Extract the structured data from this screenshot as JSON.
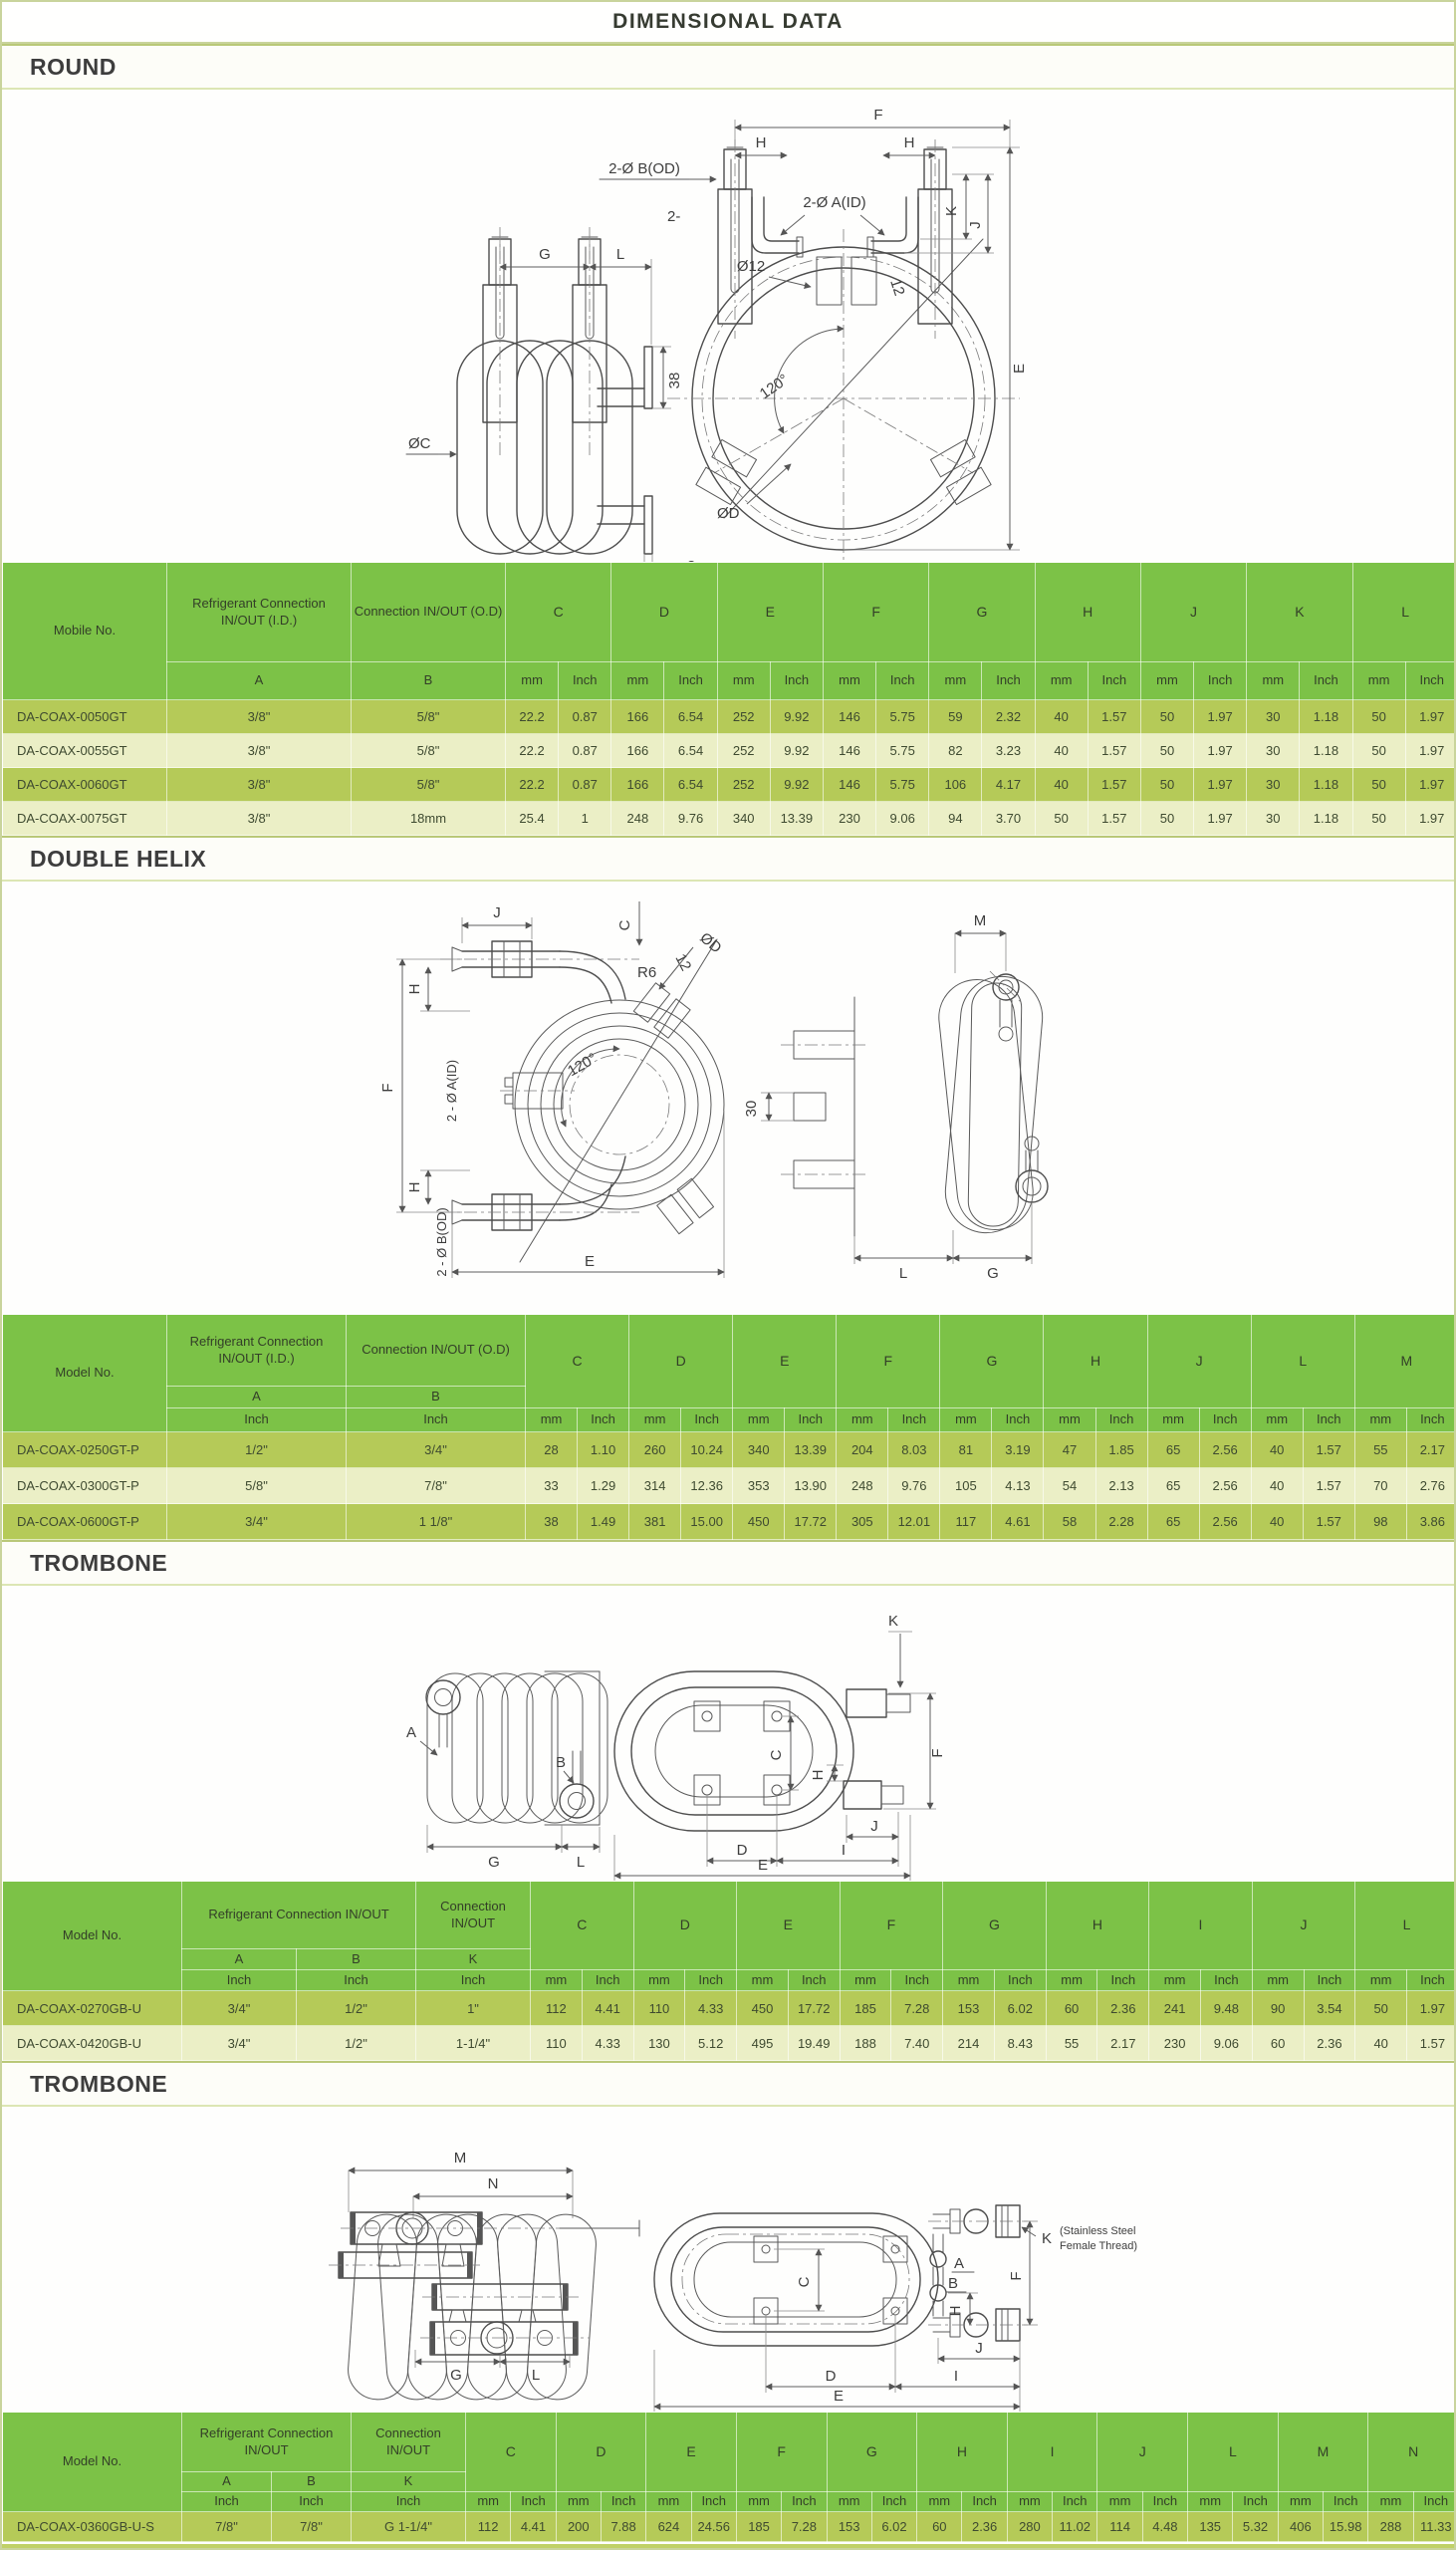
{
  "page": {
    "title": "DIMENSIONAL DATA"
  },
  "sections": [
    {
      "heading": "ROUND"
    },
    {
      "heading": "DOUBLE HELIX"
    },
    {
      "heading": "TROMBONE"
    },
    {
      "heading": "TROMBONE"
    }
  ],
  "colors": {
    "header_green": "#7cc247",
    "row_olive": "#b5ca58",
    "row_cream": "#ebefc6",
    "frame_border": "#c9d49c",
    "text_dark": "#3e4a30"
  },
  "drawings": {
    "round": {
      "g": "G",
      "l": "L",
      "oc": "ØC",
      "d38": "38",
      "d3": "3",
      "b_od": "2-Ø B(OD)",
      "two": "2-",
      "a_id": "2-Ø A(ID)",
      "f": "F",
      "h1": "H",
      "h2": "H",
      "d12": "Ø12",
      "n12": "12",
      "deg": "120°",
      "dd": "ØD",
      "e": "E",
      "k": "K",
      "j": "J"
    },
    "double_helix": {
      "j": "J",
      "c": "C",
      "dd": "ØD",
      "r6": "R6",
      "n12": "12",
      "deg": "120°",
      "h1": "H",
      "h2": "H",
      "f": "F",
      "a_id": "2 - Ø A(ID)",
      "b_od": "2 - Ø B(OD)",
      "e": "E",
      "m": "M",
      "n30": "30",
      "l": "L",
      "g": "G"
    },
    "trombone1": {
      "a": "A",
      "b": "B",
      "g": "G",
      "l": "L",
      "k": "K",
      "c": "C",
      "f": "F",
      "h": "H",
      "d": "D",
      "i": "I",
      "j": "J",
      "e": "E"
    },
    "trombone2": {
      "m": "M",
      "n": "N",
      "g": "G",
      "l": "L",
      "k": "K",
      "note1": "(Stainless Steel",
      "note2": "Female Thread)",
      "a": "A",
      "b": "B",
      "c": "C",
      "f": "F",
      "h": "H",
      "d": "D",
      "i": "I",
      "j": "J",
      "e": "E"
    }
  },
  "tables": {
    "round": {
      "model_label": "Mobile No.",
      "layout": 2,
      "units": [
        "mm",
        "Inch"
      ],
      "groups": [
        {
          "label": "Refrigerant Connection IN/OUT (I.D.)",
          "subs": [
            "A"
          ],
          "unit": ""
        },
        {
          "label": "Connection IN/OUT (O.D)",
          "subs": [
            "B"
          ],
          "unit": ""
        }
      ],
      "dims": [
        "C",
        "D",
        "E",
        "F",
        "G",
        "H",
        "J",
        "K",
        "L"
      ],
      "rows": [
        [
          "DA-COAX-0050GT",
          "3/8\"",
          "5/8\"",
          "22.2",
          "0.87",
          "166",
          "6.54",
          "252",
          "9.92",
          "146",
          "5.75",
          "59",
          "2.32",
          "40",
          "1.57",
          "50",
          "1.97",
          "30",
          "1.18",
          "50",
          "1.97"
        ],
        [
          "DA-COAX-0055GT",
          "3/8\"",
          "5/8\"",
          "22.2",
          "0.87",
          "166",
          "6.54",
          "252",
          "9.92",
          "146",
          "5.75",
          "82",
          "3.23",
          "40",
          "1.57",
          "50",
          "1.97",
          "30",
          "1.18",
          "50",
          "1.97"
        ],
        [
          "DA-COAX-0060GT",
          "3/8\"",
          "5/8\"",
          "22.2",
          "0.87",
          "166",
          "6.54",
          "252",
          "9.92",
          "146",
          "5.75",
          "106",
          "4.17",
          "40",
          "1.57",
          "50",
          "1.97",
          "30",
          "1.18",
          "50",
          "1.97"
        ],
        [
          "DA-COAX-0075GT",
          "3/8\"",
          "18mm",
          "25.4",
          "1",
          "248",
          "9.76",
          "340",
          "13.39",
          "230",
          "9.06",
          "94",
          "3.70",
          "50",
          "1.57",
          "50",
          "1.97",
          "30",
          "1.18",
          "50",
          "1.97"
        ]
      ]
    },
    "double_helix": {
      "model_label": "Model No.",
      "layout": 3,
      "units": [
        "mm",
        "Inch"
      ],
      "groups": [
        {
          "label": "Refrigerant Connection IN/OUT (I.D.)",
          "subs": [
            "A"
          ],
          "unit": "Inch"
        },
        {
          "label": "Connection IN/OUT (O.D)",
          "subs": [
            "B"
          ],
          "unit": "Inch"
        }
      ],
      "dims": [
        "C",
        "D",
        "E",
        "F",
        "G",
        "H",
        "J",
        "L",
        "M"
      ],
      "rows": [
        [
          "DA-COAX-0250GT-P",
          "1/2\"",
          "3/4\"",
          "28",
          "1.10",
          "260",
          "10.24",
          "340",
          "13.39",
          "204",
          "8.03",
          "81",
          "3.19",
          "47",
          "1.85",
          "65",
          "2.56",
          "40",
          "1.57",
          "55",
          "2.17"
        ],
        [
          "DA-COAX-0300GT-P",
          "5/8\"",
          "7/8\"",
          "33",
          "1.29",
          "314",
          "12.36",
          "353",
          "13.90",
          "248",
          "9.76",
          "105",
          "4.13",
          "54",
          "2.13",
          "65",
          "2.56",
          "40",
          "1.57",
          "70",
          "2.76"
        ],
        [
          "DA-COAX-0600GT-P",
          "3/4\"",
          "1 1/8\"",
          "38",
          "1.49",
          "381",
          "15.00",
          "450",
          "17.72",
          "305",
          "12.01",
          "117",
          "4.61",
          "58",
          "2.28",
          "65",
          "2.56",
          "40",
          "1.57",
          "98",
          "3.86"
        ]
      ]
    },
    "trombone1": {
      "model_label": "Model No.",
      "layout": 3,
      "units": [
        "mm",
        "Inch"
      ],
      "groups": [
        {
          "label": "Refrigerant Connection IN/OUT",
          "subs": [
            "A",
            "B"
          ],
          "unit": "Inch"
        },
        {
          "label": "Connection IN/OUT",
          "subs": [
            "K"
          ],
          "unit": "Inch"
        }
      ],
      "dims": [
        "C",
        "D",
        "E",
        "F",
        "G",
        "H",
        "I",
        "J",
        "L"
      ],
      "rows": [
        [
          "DA-COAX-0270GB-U",
          "3/4\"",
          "1/2\"",
          "1\"",
          "112",
          "4.41",
          "110",
          "4.33",
          "450",
          "17.72",
          "185",
          "7.28",
          "153",
          "6.02",
          "60",
          "2.36",
          "241",
          "9.48",
          "90",
          "3.54",
          "50",
          "1.97"
        ],
        [
          "DA-COAX-0420GB-U",
          "3/4\"",
          "1/2\"",
          "1-1/4\"",
          "110",
          "4.33",
          "130",
          "5.12",
          "495",
          "19.49",
          "188",
          "7.40",
          "214",
          "8.43",
          "55",
          "2.17",
          "230",
          "9.06",
          "60",
          "2.36",
          "40",
          "1.57"
        ]
      ]
    },
    "trombone2": {
      "model_label": "Model No.",
      "layout": 3,
      "units": [
        "mm",
        "Inch"
      ],
      "groups": [
        {
          "label": "Refrigerant Connection IN/OUT",
          "subs": [
            "A",
            "B"
          ],
          "unit": "Inch"
        },
        {
          "label": "Connection IN/OUT",
          "subs": [
            "K"
          ],
          "unit": "Inch"
        }
      ],
      "dims": [
        "C",
        "D",
        "E",
        "F",
        "G",
        "H",
        "I",
        "J",
        "L",
        "M",
        "N"
      ],
      "rows": [
        [
          "DA-COAX-0360GB-U-S",
          "7/8\"",
          "7/8\"",
          "G 1-1/4\"",
          "112",
          "4.41",
          "200",
          "7.88",
          "624",
          "24.56",
          "185",
          "7.28",
          "153",
          "6.02",
          "60",
          "2.36",
          "280",
          "11.02",
          "114",
          "4.48",
          "135",
          "5.32",
          "406",
          "15.98",
          "288",
          "11.33"
        ]
      ]
    }
  }
}
